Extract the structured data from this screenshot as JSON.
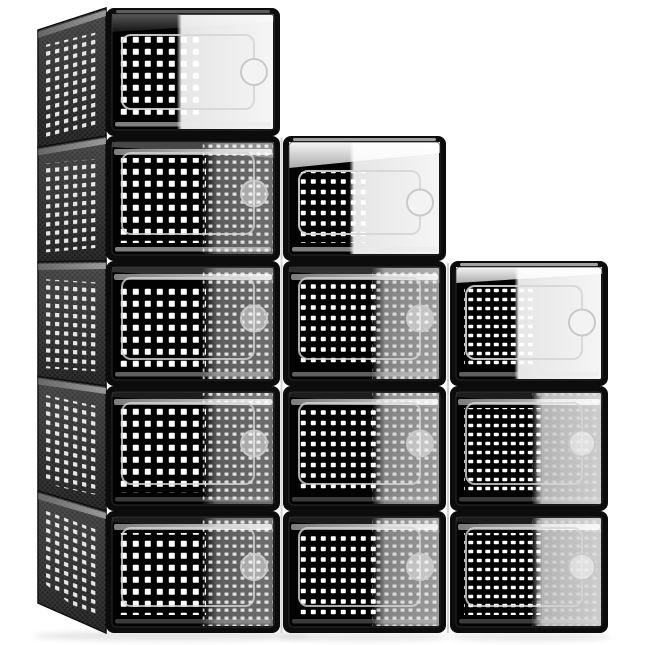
{
  "meta": {
    "description": "Product photograph of 12 stackable clear-front shoe storage boxes with black frames and perforated ventilation panels, stacked in a 5-4-3 staircase arrangement on a plain white background"
  },
  "product": {
    "name": "Stackable shoe storage boxes",
    "box_count": 12,
    "stack_pattern": "staircase",
    "columns": [
      {
        "position": "left",
        "boxes": 5
      },
      {
        "position": "middle",
        "boxes": 4
      },
      {
        "position": "right",
        "boxes": 3
      }
    ],
    "features": [
      "clear drop-front door",
      "round finger-pull hole",
      "square ventilation holes",
      "black plastic frame",
      "perforated side panels"
    ]
  },
  "palette": {
    "background": "#ffffff",
    "frame": "#0c0c0c",
    "interior": "#020202",
    "vent_hole": "#fdfdfd",
    "side_panel_top": "#424242",
    "side_panel_bottom": "#1d1d1d",
    "lid_highlight": "#f6f6f6",
    "lid_shade": "#ababab",
    "lip_light": "#ececec",
    "lip_dark": "#8a8a8a",
    "emboss_line": "#d6d6d6",
    "finger_ring": "#c9c9c9",
    "gap_line": "#c9c9c9",
    "shadow": "#000000"
  },
  "scene": {
    "canvas": {
      "width": 645,
      "height": 645
    },
    "rows": [
      8,
      136,
      261,
      386,
      511,
      633
    ],
    "columns": [
      {
        "id": "left",
        "x": 106,
        "width": 174,
        "first_row": 0,
        "box_count": 5,
        "sheen": "a",
        "sheen_start": 0.56,
        "texture_dots": 0.8,
        "texture_mesh": 0.55,
        "perforation": {
          "pitch_x": 12,
          "pitch_y": 12,
          "hole_w": 6,
          "hole_h": 6
        },
        "lid": {
          "left_drop": 18,
          "right_drop": 8,
          "light": false
        }
      },
      {
        "id": "middle",
        "x": 283,
        "width": 163,
        "first_row": 1,
        "box_count": 4,
        "sheen": "b",
        "sheen_start": 0.55,
        "texture_dots": 0.7,
        "texture_mesh": 0.45,
        "perforation": {
          "pitch_x": 10,
          "pitch_y": 10.5,
          "hole_w": 5,
          "hole_h": 4.4
        },
        "lid": {
          "left_drop": 26,
          "right_drop": 11,
          "light": true
        }
      },
      {
        "id": "right",
        "x": 450,
        "width": 158,
        "first_row": 2,
        "box_count": 3,
        "sheen": "c",
        "sheen_start": 0.52,
        "texture_dots": 0.35,
        "texture_mesh": 0.25,
        "perforation": {
          "pitch_x": 8.5,
          "pitch_y": 9,
          "hole_w": 5,
          "hole_h": 3.4
        },
        "lid": {
          "left_drop": 16,
          "right_drop": 7,
          "light": true
        }
      }
    ],
    "sheen_start_top": 0.4,
    "side_panel": {
      "front_x": 106,
      "back_x": 38,
      "top_offset": 22,
      "bottom_offset": -30
    },
    "gaps": [
      {
        "x": 280.5,
        "y": 138,
        "w": 2,
        "h": 495
      },
      {
        "x": 447,
        "y": 263,
        "w": 2,
        "h": 370
      }
    ],
    "shadows": [
      {
        "cx": 172,
        "cy": 636,
        "rx": 140,
        "ry": 5
      },
      {
        "cx": 364,
        "cy": 637,
        "rx": 86,
        "ry": 4
      },
      {
        "cx": 530,
        "cy": 637,
        "rx": 81,
        "ry": 4
      }
    ]
  }
}
